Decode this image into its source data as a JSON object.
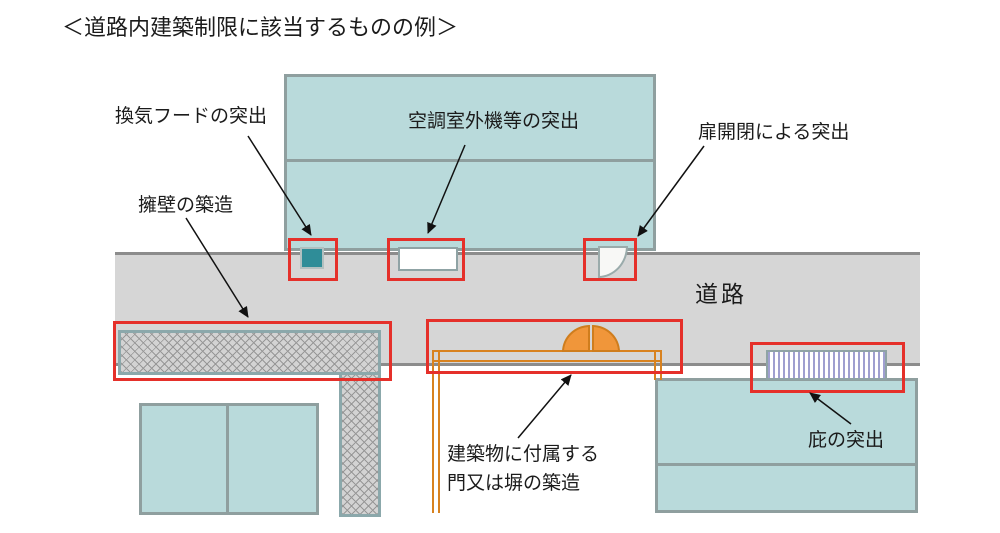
{
  "title": "＜道路内建築制限に該当するものの例＞",
  "diagram": {
    "road_label": "道路",
    "annotations": {
      "vent_hood": "換気フードの突出",
      "ac_outdoor_unit": "空調室外機等の突出",
      "door_swing": "扉開閉による突出",
      "retaining_wall": "擁壁の築造",
      "attached_gate_line1": "建築物に付属する",
      "attached_gate_line2": "門又は塀の築造",
      "eaves": "庇の突出"
    }
  },
  "colors": {
    "building_fill": "#b9dadb",
    "building_border": "#8f9f9f",
    "road_fill": "#d6d6d6",
    "road_border": "#8c8c8c",
    "highlight_red": "#e5302a",
    "vent_hood_teal": "#2f8d98",
    "gate_orange": "#d8821f",
    "gate_leaf_fill": "#f0963a",
    "awning_stripe": "#9f9fd0",
    "hatch_line": "#979797",
    "text": "#1b1b1b"
  }
}
